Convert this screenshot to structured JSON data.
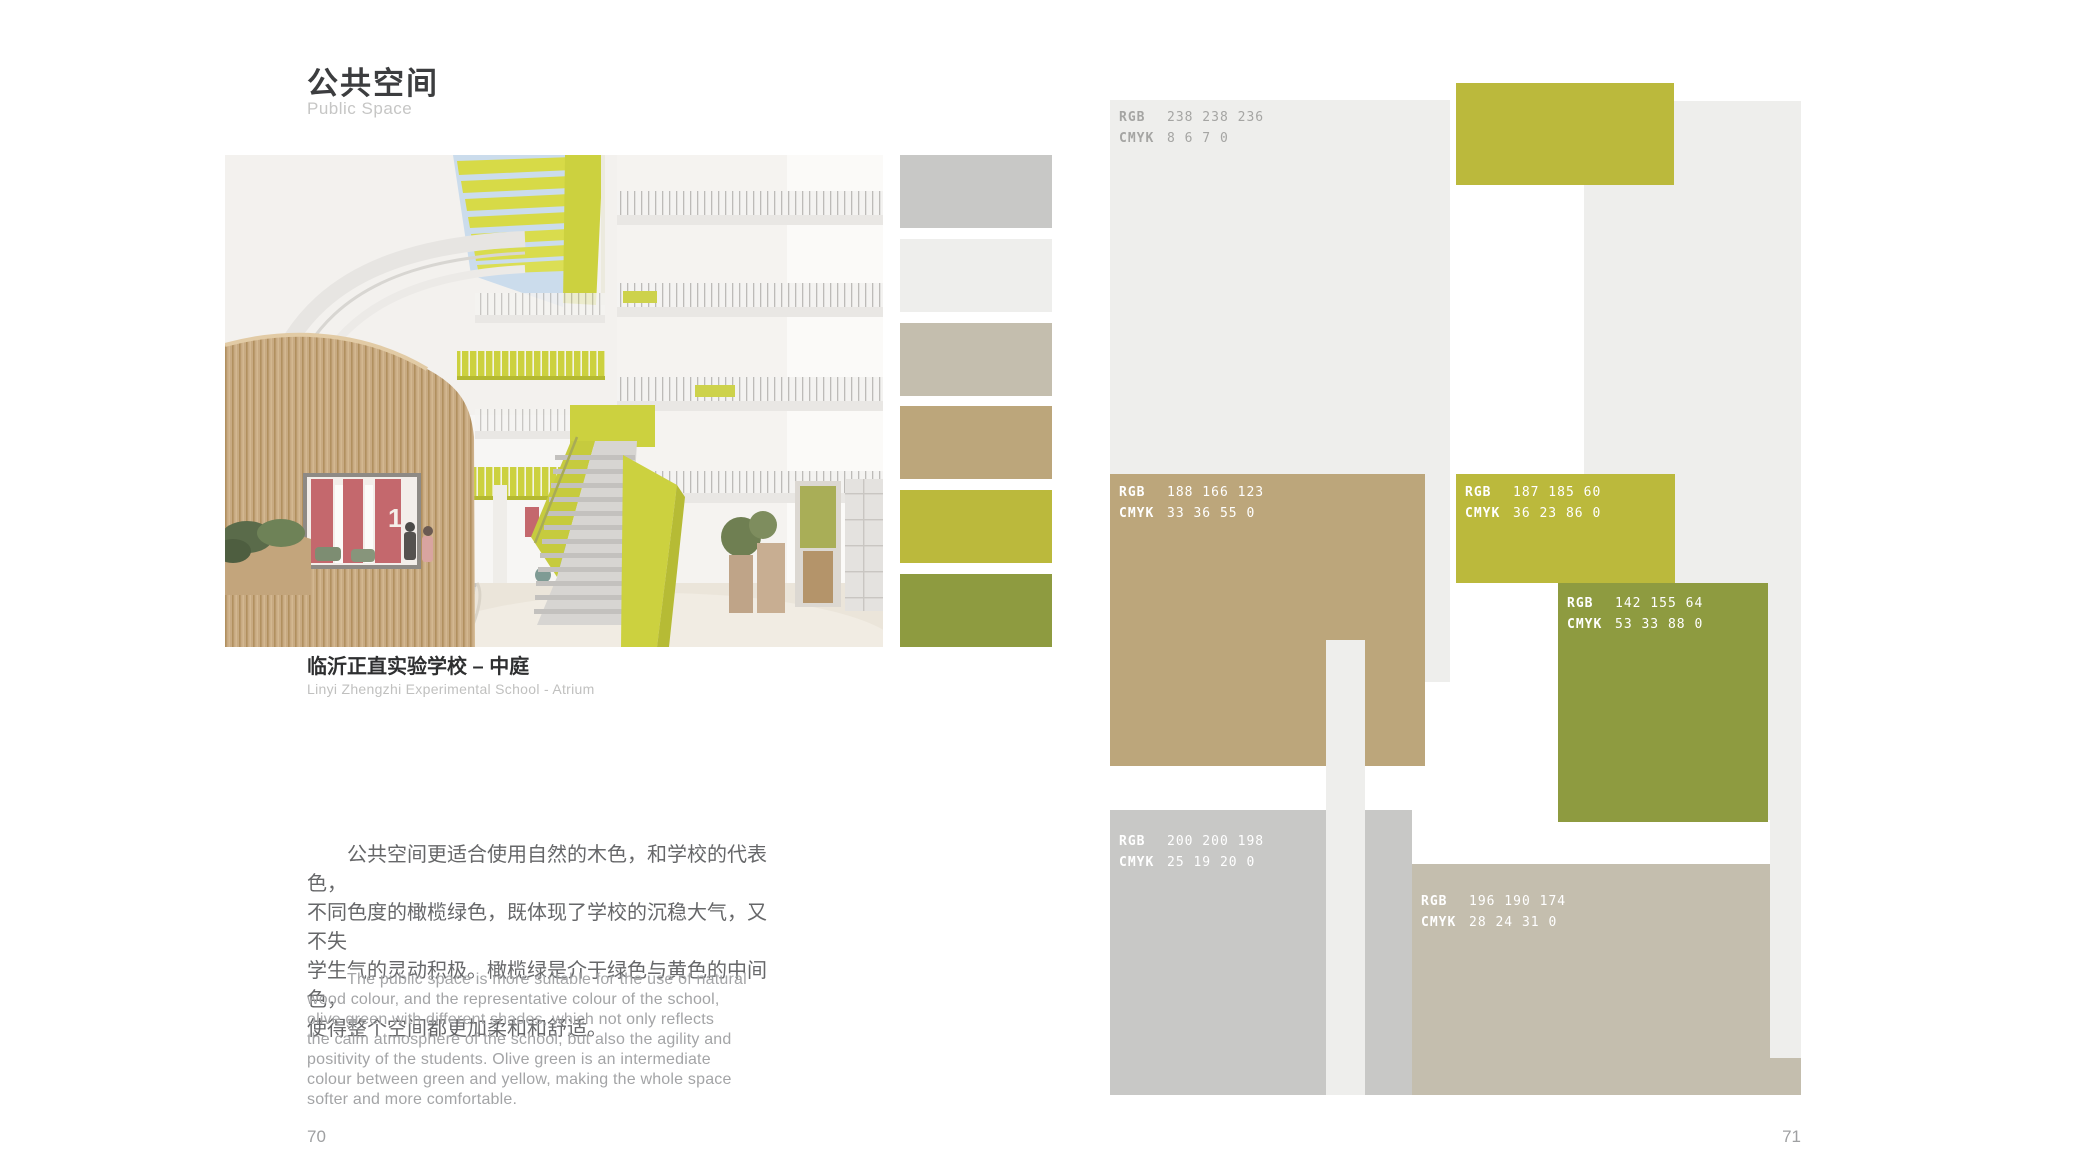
{
  "page": {
    "left_page_number": "70",
    "right_page_number": "71",
    "background": "#ffffff"
  },
  "header": {
    "title": "公共空间",
    "subtitle": "Public Space"
  },
  "photo": {
    "caption_zh": "临沂正直实验学校 – 中庭",
    "caption_en": "Linyi Zhengzhi Experimental School - Atrium",
    "description": "architectural render of a white multi-storey school atrium with skylight, yellow-green railings, curved wood-slat volume and central staircase"
  },
  "body_zh": {
    "lines": [
      "公共空间更适合使用自然的木色，和学校的代表色，",
      "不同色度的橄榄绿色，既体现了学校的沉稳大气，又不失",
      "学生气的灵动积极。橄榄绿是介于绿色与黄色的中间色，",
      "使得整个空间都更加柔和和舒适。"
    ]
  },
  "body_en": {
    "lines": [
      "The public space is more suitable for the use of natural",
      "wood colour, and the representative colour of the school,",
      "olive green with different shades, which not only reflects",
      "the calm atmosphere of the school, but also the agility and",
      "positivity of the students. Olive green is an intermediate",
      "colour between green and yellow, making the whole space",
      "softer and more comfortable."
    ]
  },
  "swatches": {
    "items": [
      {
        "name": "gray",
        "hex": "#c8c8c6"
      },
      {
        "name": "light-gray",
        "hex": "#eeeeec"
      },
      {
        "name": "greige",
        "hex": "#c4beae"
      },
      {
        "name": "tan",
        "hex": "#bca67b"
      },
      {
        "name": "yellow-green",
        "hex": "#bbb93c"
      },
      {
        "name": "olive-green",
        "hex": "#8e9b40"
      }
    ]
  },
  "palette": {
    "label_rgb": "RGB",
    "label_cmyk": "CMYK",
    "blocks": {
      "light": {
        "rgb": "238 238 236",
        "cmyk": "8 6 7 0",
        "hex": "#eeeeec"
      },
      "tan": {
        "rgb": "188 166 123",
        "cmyk": "33 36 55 0",
        "hex": "#bca67b"
      },
      "yellow": {
        "rgb": "187 185 60",
        "cmyk": "36 23 86 0",
        "hex": "#bbb93c"
      },
      "olive": {
        "rgb": "142 155 64",
        "cmyk": "53 33 88 0",
        "hex": "#8e9b40"
      },
      "gray": {
        "rgb": "200 200 198",
        "cmyk": "25 19 20 0",
        "hex": "#c8c8c6"
      },
      "greige": {
        "rgb": "196 190 174",
        "cmyk": "28 24 31 0",
        "hex": "#c4beae"
      },
      "yellow_top_hex": "#bbb93c",
      "strip_hex": "#eeeeec"
    }
  }
}
